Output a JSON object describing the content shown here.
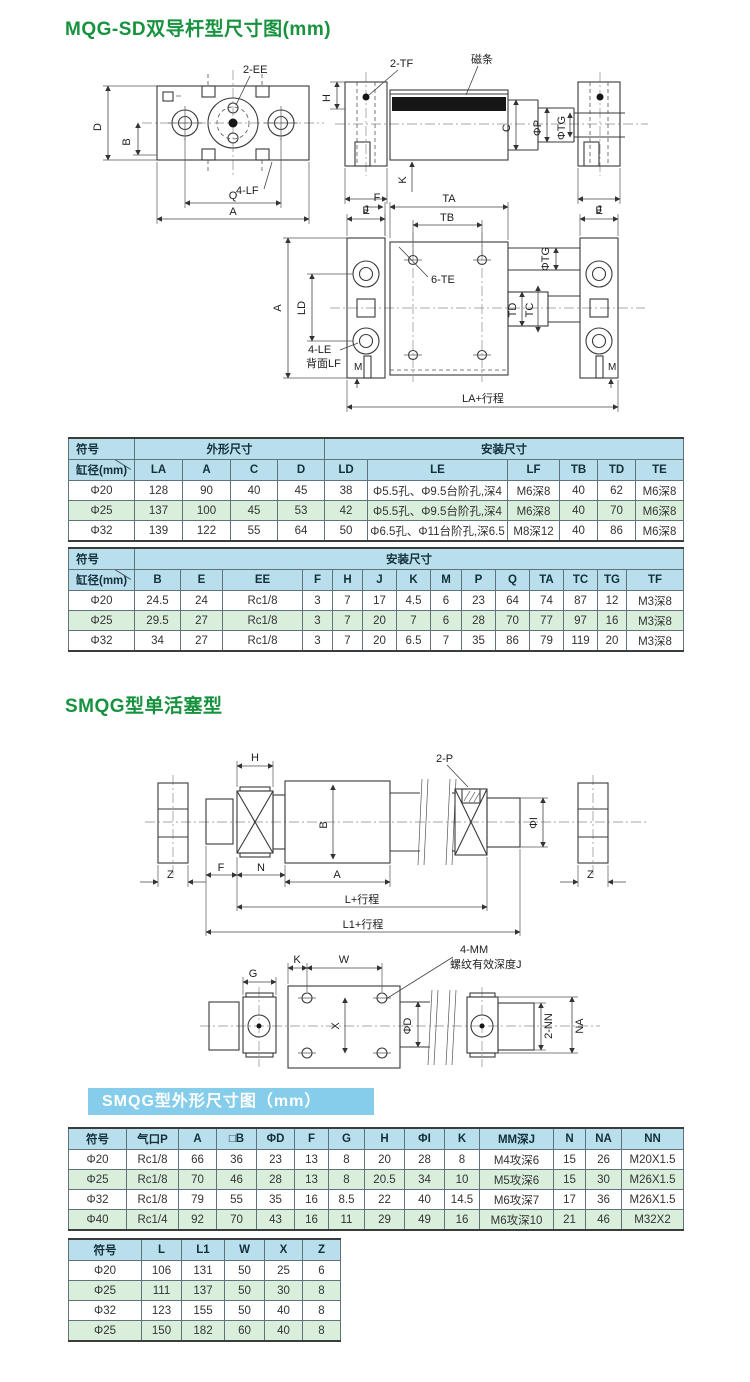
{
  "titles": {
    "mqg": "MQG-SD双导杆型尺寸图(mm)",
    "smqg": "SMQG型单活塞型",
    "banner": "SMQG型外形尺寸图（mm）"
  },
  "colors": {
    "title_green": "#17923f",
    "banner_blue": "#85cdea",
    "table_header_blue": "#b9dfec",
    "table_row_green": "#d9efdc",
    "magnet_strip_black": "#161616"
  },
  "diagrams": {
    "mqg_front": {
      "ee": "2-EE",
      "d": "D",
      "b": "B",
      "lf": "4-LF",
      "q": "Q",
      "a": "A"
    },
    "mqg_side": {
      "tf": "2-TF",
      "magnet": "磁条",
      "h": "H",
      "c": "C",
      "p": "ΦP",
      "tg": "ΦTG",
      "k": "K",
      "j_left": "J",
      "j_right": "J"
    },
    "mqg_bottom": {
      "f": "F",
      "ta": "TA",
      "tb": "TB",
      "e_left": "E",
      "e_right": "E",
      "te": "6-TE",
      "tg": "ΦTG",
      "ld": "LD",
      "td": "TD",
      "tc": "TC",
      "a": "A",
      "le": "4-LE",
      "lf_back": "背面LF",
      "m_left": "M",
      "m_right": "M",
      "la_stroke": "LA+行程"
    },
    "smqg_side": {
      "h": "H",
      "p": "2-P",
      "b": "B",
      "i": "ΦI",
      "z_left": "Z",
      "z_right": "Z",
      "f": "F",
      "n": "N",
      "a": "A",
      "l_stroke": "L+行程",
      "l1_stroke": "L1+行程",
      "mm": "4-MM",
      "thread_depth": "螺纹有效深度J"
    },
    "smqg_bottom": {
      "g": "G",
      "k": "K",
      "w": "W",
      "x": "X",
      "d": "ΦD",
      "nn": "2-NN",
      "na": "NA"
    }
  },
  "table1": {
    "group_headers": [
      "符号",
      "外形尺寸",
      "安装尺寸"
    ],
    "sub_headers": [
      "缸径(mm)",
      "LA",
      "A",
      "C",
      "D",
      "LD",
      "LE",
      "LF",
      "TB",
      "TD",
      "TE"
    ],
    "rows": [
      [
        "Φ20",
        "128",
        "90",
        "40",
        "45",
        "38",
        "Φ5.5孔、Φ9.5台阶孔,深4",
        "M6深8",
        "40",
        "62",
        "M6深8"
      ],
      [
        "Φ25",
        "137",
        "100",
        "45",
        "53",
        "42",
        "Φ5.5孔、Φ9.5台阶孔,深4",
        "M6深8",
        "40",
        "70",
        "M6深8"
      ],
      [
        "Φ32",
        "139",
        "122",
        "55",
        "64",
        "50",
        "Φ6.5孔、Φ11台阶孔,深6.5",
        "M8深12",
        "40",
        "86",
        "M6深8"
      ]
    ]
  },
  "table2": {
    "group_headers": [
      "符号",
      "安装尺寸"
    ],
    "sub_headers": [
      "缸径(mm)",
      "B",
      "E",
      "EE",
      "F",
      "H",
      "J",
      "K",
      "M",
      "P",
      "Q",
      "TA",
      "TC",
      "TG",
      "TF"
    ],
    "rows": [
      [
        "Φ20",
        "24.5",
        "24",
        "Rc1/8",
        "3",
        "7",
        "17",
        "4.5",
        "6",
        "23",
        "64",
        "74",
        "87",
        "12",
        "M3深8"
      ],
      [
        "Φ25",
        "29.5",
        "27",
        "Rc1/8",
        "3",
        "7",
        "20",
        "7",
        "6",
        "28",
        "70",
        "77",
        "97",
        "16",
        "M3深8"
      ],
      [
        "Φ32",
        "34",
        "27",
        "Rc1/8",
        "3",
        "7",
        "20",
        "6.5",
        "7",
        "35",
        "86",
        "79",
        "119",
        "20",
        "M3深8"
      ]
    ]
  },
  "table3": {
    "headers": [
      "符号",
      "气口P",
      "A",
      "□B",
      "ΦD",
      "F",
      "G",
      "H",
      "ΦI",
      "K",
      "MM深J",
      "N",
      "NA",
      "NN"
    ],
    "rows": [
      [
        "Φ20",
        "Rc1/8",
        "66",
        "36",
        "23",
        "13",
        "8",
        "20",
        "28",
        "8",
        "M4攻深6",
        "15",
        "26",
        "M20X1.5"
      ],
      [
        "Φ25",
        "Rc1/8",
        "70",
        "46",
        "28",
        "13",
        "8",
        "20.5",
        "34",
        "10",
        "M5攻深6",
        "15",
        "30",
        "M26X1.5"
      ],
      [
        "Φ32",
        "Rc1/8",
        "79",
        "55",
        "35",
        "16",
        "8.5",
        "22",
        "40",
        "14.5",
        "M6攻深7",
        "17",
        "36",
        "M26X1.5"
      ],
      [
        "Φ40",
        "Rc1/4",
        "92",
        "70",
        "43",
        "16",
        "11",
        "29",
        "49",
        "16",
        "M6攻深10",
        "21",
        "46",
        "M32X2"
      ]
    ]
  },
  "table4": {
    "headers": [
      "符号",
      "L",
      "L1",
      "W",
      "X",
      "Z"
    ],
    "rows": [
      [
        "Φ20",
        "106",
        "131",
        "50",
        "25",
        "6"
      ],
      [
        "Φ25",
        "111",
        "137",
        "50",
        "30",
        "8"
      ],
      [
        "Φ32",
        "123",
        "155",
        "50",
        "40",
        "8"
      ],
      [
        "Φ25",
        "150",
        "182",
        "60",
        "40",
        "8"
      ]
    ]
  }
}
